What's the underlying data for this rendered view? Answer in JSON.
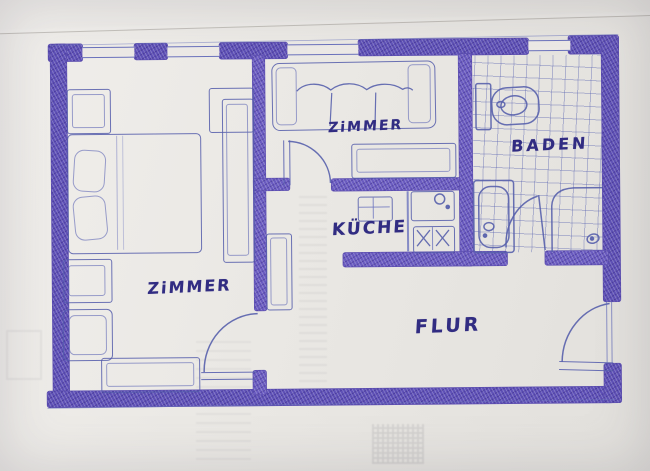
{
  "floor_plan": {
    "rooms": [
      {
        "id": "bedroom",
        "label": "ZiMMER"
      },
      {
        "id": "living_room",
        "label": "ZiMMER"
      },
      {
        "id": "kitchen",
        "label": "KÜCHE"
      },
      {
        "id": "bathroom",
        "label": "BADEN"
      },
      {
        "id": "hallway",
        "label": "FLUR"
      }
    ],
    "fixtures": [
      "bed",
      "pillows",
      "nightstand",
      "desk",
      "stool",
      "sideboard",
      "wardrobe",
      "shelf",
      "couch",
      "living-table",
      "kitchen-table",
      "sink-counter",
      "stove",
      "toilet",
      "bathtub",
      "shower",
      "hall-shelf"
    ],
    "doors": [
      "bedroom-door",
      "living-room-door",
      "bathroom-door",
      "entry-door"
    ],
    "windows_count": 4,
    "colors": {
      "paper": "#eae8e4",
      "wall_ink": "#5e50b6",
      "sketch_ink": "#5c64ae",
      "text_ink": "#312c82"
    }
  }
}
